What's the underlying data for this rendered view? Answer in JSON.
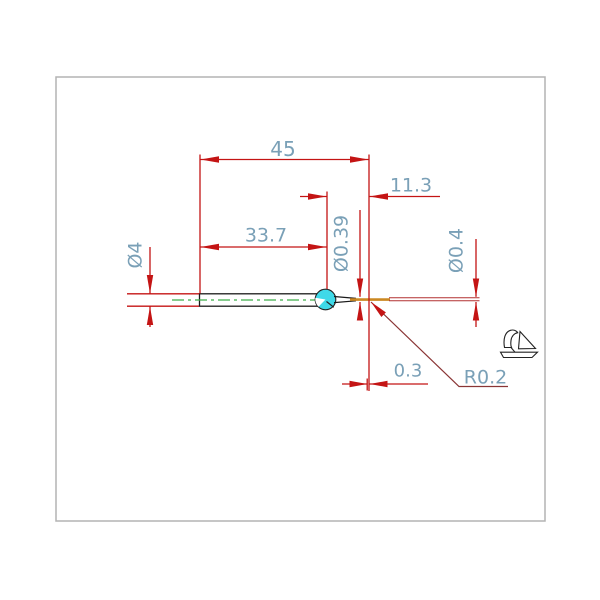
{
  "drawing": {
    "title": "stylus tip dimension drawing",
    "dimensions": {
      "overall_length": "45",
      "tip_length": "11.3",
      "length_to_ball_center": "33.7",
      "tip_diameter": "Ø0.39",
      "shank_diameter": "Ø4",
      "end_tip_diameter": "Ø0.4",
      "tip_flat_length": "0.3",
      "tip_radius": "R0.2"
    },
    "colors": {
      "dimension_line": "#c41414",
      "dimension_text": "#7aa0b7",
      "centerline": "#3fae4a",
      "part_outline": "#1a1a1a",
      "ball_fill": "#3fd9e8",
      "tip_highlight": "#cc8822",
      "leader_line": "#8a3535",
      "frame": "#b3b3b3"
    },
    "icons": {
      "logo": "bird-logo-icon",
      "ball": "stylus-ball"
    }
  }
}
